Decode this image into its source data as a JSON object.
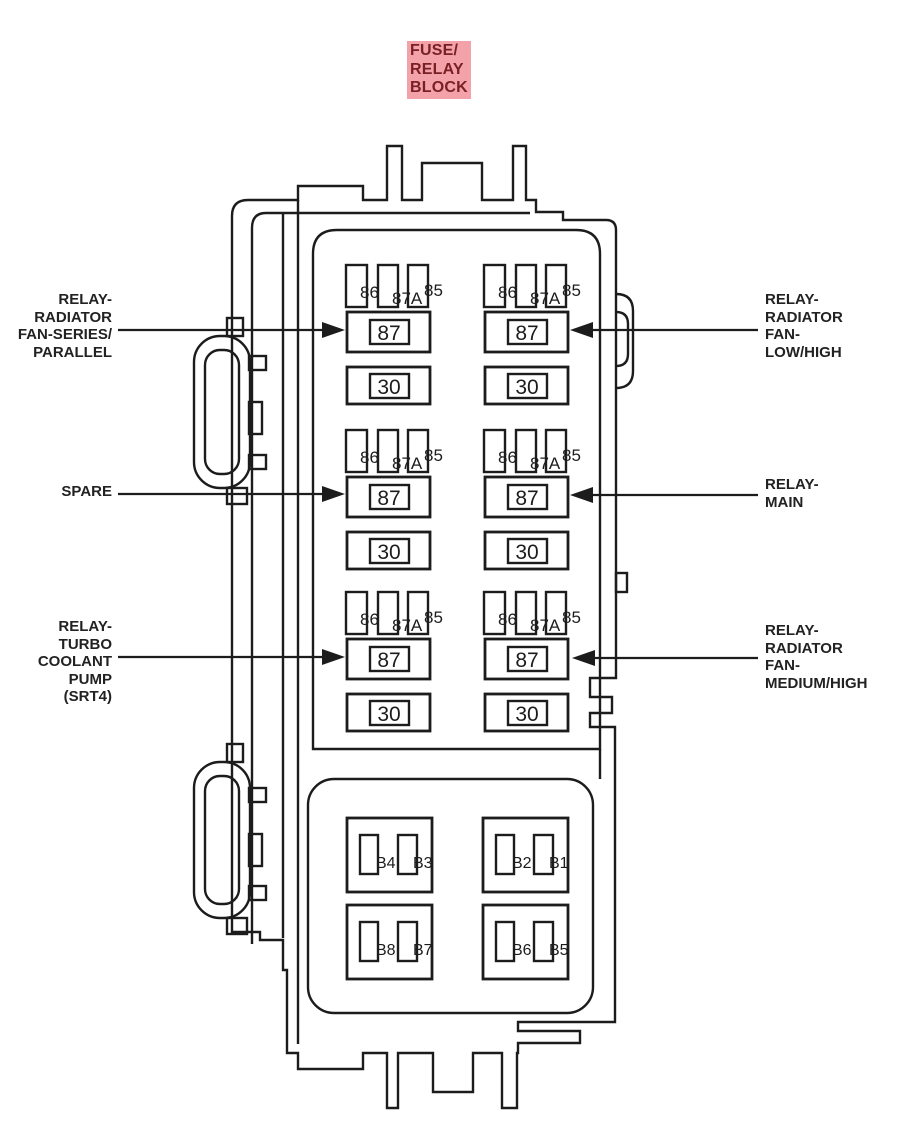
{
  "title": {
    "lines": [
      "FUSE/",
      "RELAY",
      "BLOCK"
    ]
  },
  "colors": {
    "line": "#1c1c1c",
    "title_bg": "#f2a2a8",
    "title_fg": "#7a1f24"
  },
  "callouts": {
    "left": [
      {
        "id": "relay-radiator-fan-series-parallel",
        "lines": [
          "RELAY-",
          "RADIATOR",
          "FAN-SERIES/",
          "PARALLEL"
        ]
      },
      {
        "id": "spare",
        "lines": [
          "SPARE"
        ]
      },
      {
        "id": "relay-turbo-coolant-pump-srt4",
        "lines": [
          "RELAY-",
          "TURBO",
          "COOLANT",
          "PUMP",
          "(SRT4)"
        ]
      }
    ],
    "right": [
      {
        "id": "relay-radiator-fan-low-high",
        "lines": [
          "RELAY-",
          "RADIATOR",
          "FAN-",
          "LOW/HIGH"
        ]
      },
      {
        "id": "relay-main",
        "lines": [
          "RELAY-",
          "MAIN"
        ]
      },
      {
        "id": "relay-radiator-fan-medium-high",
        "lines": [
          "RELAY-",
          "RADIATOR",
          "FAN-",
          "MEDIUM/HIGH"
        ]
      }
    ]
  },
  "relay": {
    "pin_labels": [
      "86",
      "87A",
      "85"
    ],
    "terminal_labels": [
      "87",
      "30"
    ]
  },
  "fuse_boxes": [
    {
      "labels": [
        "B4",
        "B3"
      ]
    },
    {
      "labels": [
        "B2",
        "B1"
      ]
    },
    {
      "labels": [
        "B8",
        "B7"
      ]
    },
    {
      "labels": [
        "B6",
        "B5"
      ]
    }
  ]
}
